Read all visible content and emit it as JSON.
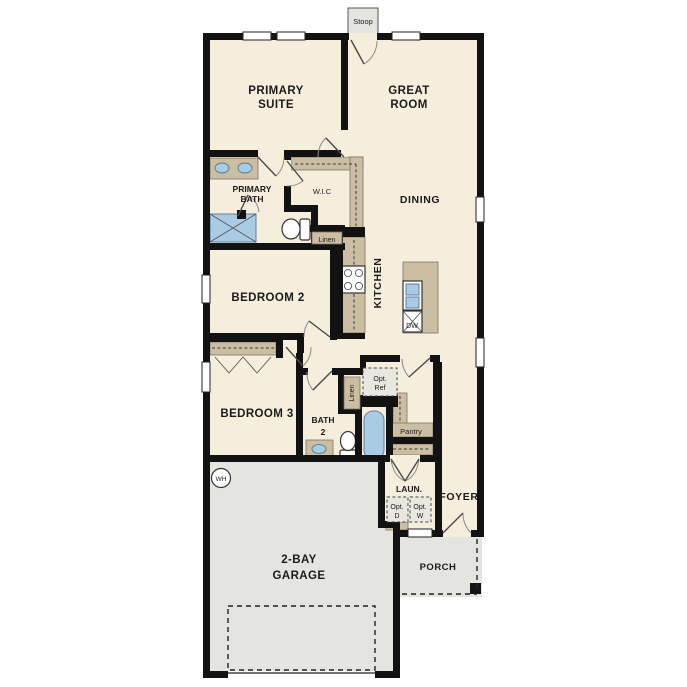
{
  "labels": {
    "stoop": "Stoop",
    "primary_suite": [
      "PRIMARY",
      "SUITE"
    ],
    "great_room": [
      "GREAT",
      "ROOM"
    ],
    "primary_bath": [
      "PRIMARY",
      "BATH"
    ],
    "wic": "W.I.C",
    "dining": "DINING",
    "linen_hall": "Linen",
    "bedroom2": "BEDROOM 2",
    "kitchen": "KITCHEN",
    "dishwasher": "DW",
    "bedroom3": "BEDROOM 3",
    "bath2": [
      "BATH",
      "2"
    ],
    "linen_bath": "Linen",
    "opt_ref": [
      "Opt.",
      "Ref"
    ],
    "pantry": "Pantry",
    "laundry": "LAUN.",
    "foyer": "FOYER",
    "opt_dryer": [
      "Opt.",
      "D"
    ],
    "opt_washer": [
      "Opt.",
      "W"
    ],
    "water_heater": "WH",
    "garage": [
      "2-BAY",
      "GARAGE"
    ],
    "porch": "PORCH"
  },
  "colors": {
    "floor": "#f5eedd",
    "wall": "#121212",
    "counter": "#cbbea2",
    "fixture": "#a9cbe4",
    "concrete": "#e4e4e0",
    "optbox": "#e9e7df"
  }
}
